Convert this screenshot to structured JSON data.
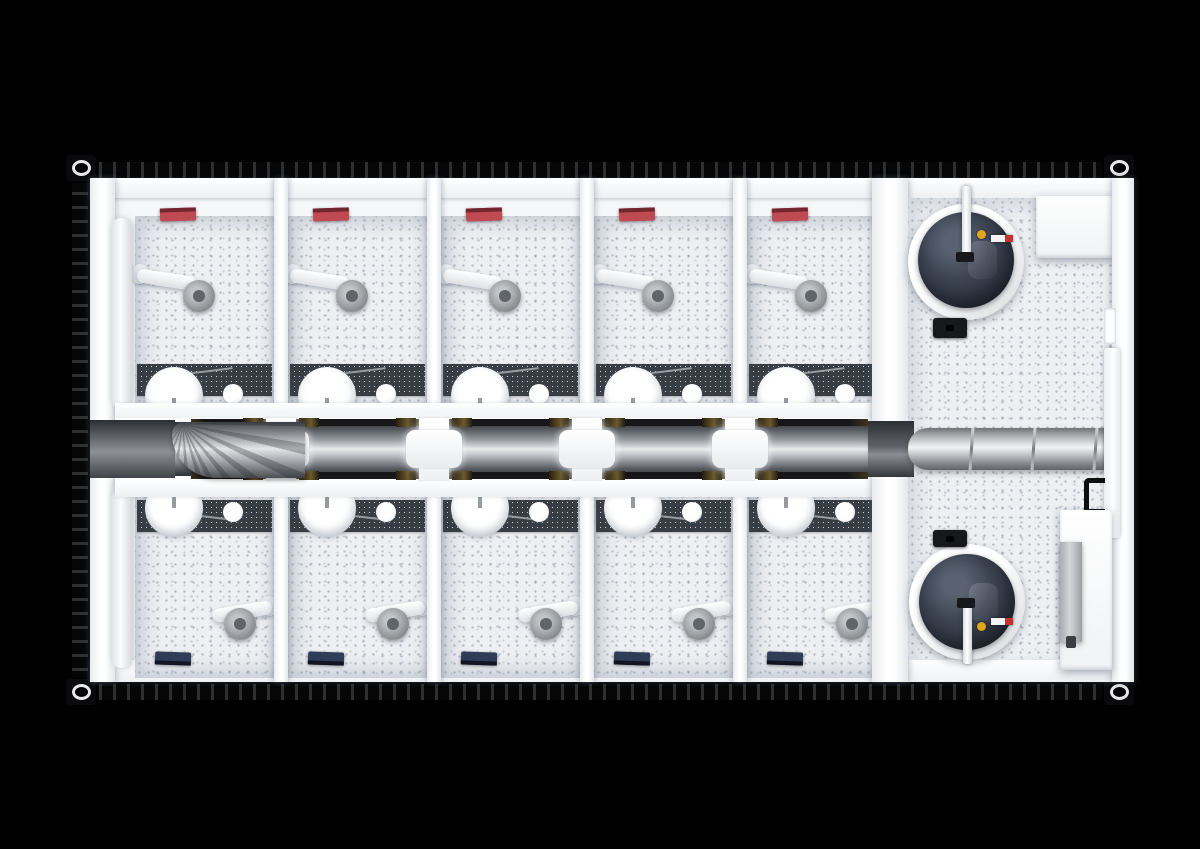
{
  "scene": {
    "description": "Top-down cutaway rendering of a sanitary shower container: ten shower cubicles in two rows, central ventilation duct with cross junctions, and a technical room with two water boilers",
    "stall_rows": {
      "top": 5,
      "bottom": 5
    },
    "stall_fixtures": [
      "wall-heater",
      "shower-arm",
      "shower-head",
      "mosaic-tile-strip",
      "washbasin",
      "faucet",
      "soap-dispenser"
    ],
    "corridor": {
      "duct_type": "rectangular-ventilation-duct",
      "cross_junctions": 4,
      "elbow_bends": 1
    },
    "technical_room": {
      "boilers": 2,
      "items": [
        "storage-cabinet",
        "round-air-duct",
        "door-handle",
        "electrical-panel",
        "riser-pipe"
      ]
    },
    "colors": {
      "background": "#000000",
      "shell_black": "#0c0c0e",
      "interior_white": "#f6f7f9",
      "floor_base": "#edeff2",
      "mosaic_dark": "#383d44",
      "duct_dark": "#3a3e43",
      "duct_light": "#e8eaec",
      "heater_red": "#c04a52",
      "heater_red_dark": "#70262c",
      "heater_navy": "#2f3d58",
      "heater_navy_dark": "#10151f",
      "boiler_navy": "#3e4553",
      "boiler_yellow": "#e2a61c",
      "label_red": "#c4332d",
      "cut_brown": "#55451f",
      "chrome_gray": "#979ba0"
    }
  }
}
